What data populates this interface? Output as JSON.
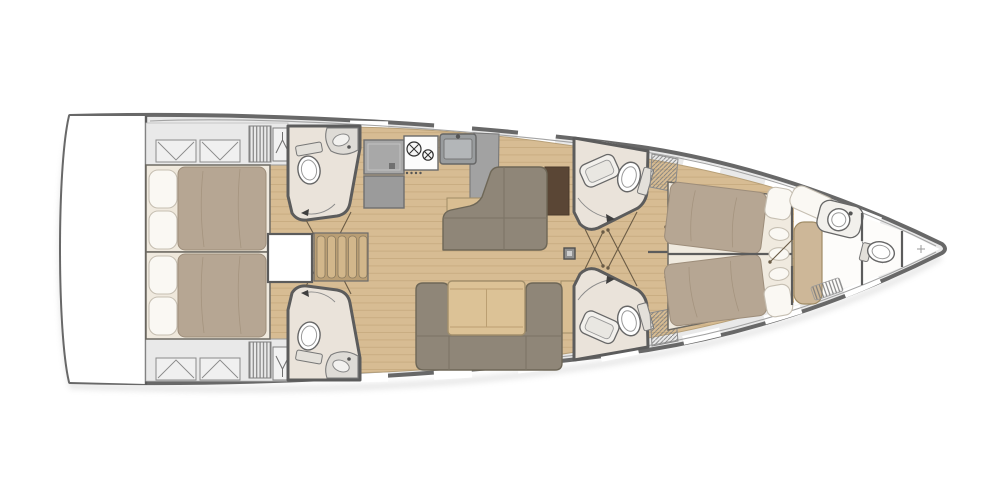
{
  "meta": {
    "description": "Sailing yacht interior layout floor plan, top-down view, bow pointing right",
    "width": 993,
    "height": 496
  },
  "areas": {
    "swim_platform": "swim platform / transom",
    "aft_cabin_port": "aft double cabin (port)",
    "aft_cabin_starboard": "aft double cabin (starboard)",
    "aft_head_port": "aft head with toilet and washbasin (port)",
    "aft_head_starboard": "aft head with toilet and washbasin (starboard)",
    "companionway": "companionway steps and engine hatch",
    "galley": "galley with fridge, two-burner stove and sink",
    "salon": "salon with chaise sofa, U-shaped settee and table",
    "mid_head_port": "mid head with washbasin and toilet (port)",
    "mid_head_starboard": "mid head with washbasin and toilet (starboard)",
    "forward_cabin": "forward owner cabin with split double berth",
    "forward_head": "forward head with washbasin, toilet and shower",
    "bow_locker": "bow anchor locker",
    "mast": "mast position"
  },
  "icons": {
    "hatch_locker": "deck-hatch-icon",
    "hanging_locker": "hanger-icon",
    "vent": "louvre-vent-icon",
    "burners": "stove-burner-icon",
    "mast_mark": "mast-section-icon",
    "bow_mark": "crosshair-icon"
  },
  "colors": {
    "bg": "#ffffff",
    "shadow": "#c9c9c9",
    "hullStroke": "#686868",
    "hullInnerLine": "#a3a3a3",
    "deck": "#e9e9e9",
    "deckSegment": "#ffffff",
    "deckEdge": "#bdbdbd",
    "wall": "#5c5c5c",
    "wood": "#d7bc93",
    "woodLine": "#c9ad82",
    "woodEdge": "#b8a078",
    "headFloor": "#eae3da",
    "headWhiteFloor": "#fdfcfa",
    "bedBase": "#f0eadf",
    "bedFrame": "#6e6a62",
    "mattress": "#b6a693",
    "mattressSeam": "#a5947f",
    "mattressEdge": "#9d8d7a",
    "sheetFold": "#efe8db",
    "pillow": "#faf8f3",
    "pillowEdge": "#c6bfb2",
    "counter": "#a2a2a2",
    "counterEdge": "#787878",
    "fridgeGray": "#a8a8a8",
    "applianceGray": "#9b9b9b",
    "stoveWhite": "#fcfcfc",
    "burnerStroke": "#2e2e2e",
    "sinkSteel": "#999c9e",
    "sinkInner": "#b3b6b8",
    "fixtureWhite": "#ffffff",
    "fixtureEdge": "#676767",
    "fixtureInner": "#999999",
    "porcelainShadow": "#e3e0da",
    "sofa": "#8f8678",
    "sofaEdge": "#6e6757",
    "sofaSeam": "#7b7365",
    "tableWood": "#dcc296",
    "tableEdge": "#a3906c",
    "tableLine": "#bb9f72",
    "sideboard": "#d9be92",
    "benchTan": "#cdb798",
    "trimEdge": "#a08c66",
    "rug": "#5a4635",
    "rugEdge": "#49392b",
    "stair": "#d2b78b",
    "stairEdge": "#8a7a5f",
    "stairBase": "#b99e74",
    "doorLine": "#6b5c46",
    "arcLine": "#8a8a8a",
    "hatchLine": "#7d7d7d",
    "mast": "#909090",
    "mastInner": "#cfcfcf",
    "white": "#ffffff",
    "crossMark": "#9a9a9a"
  }
}
